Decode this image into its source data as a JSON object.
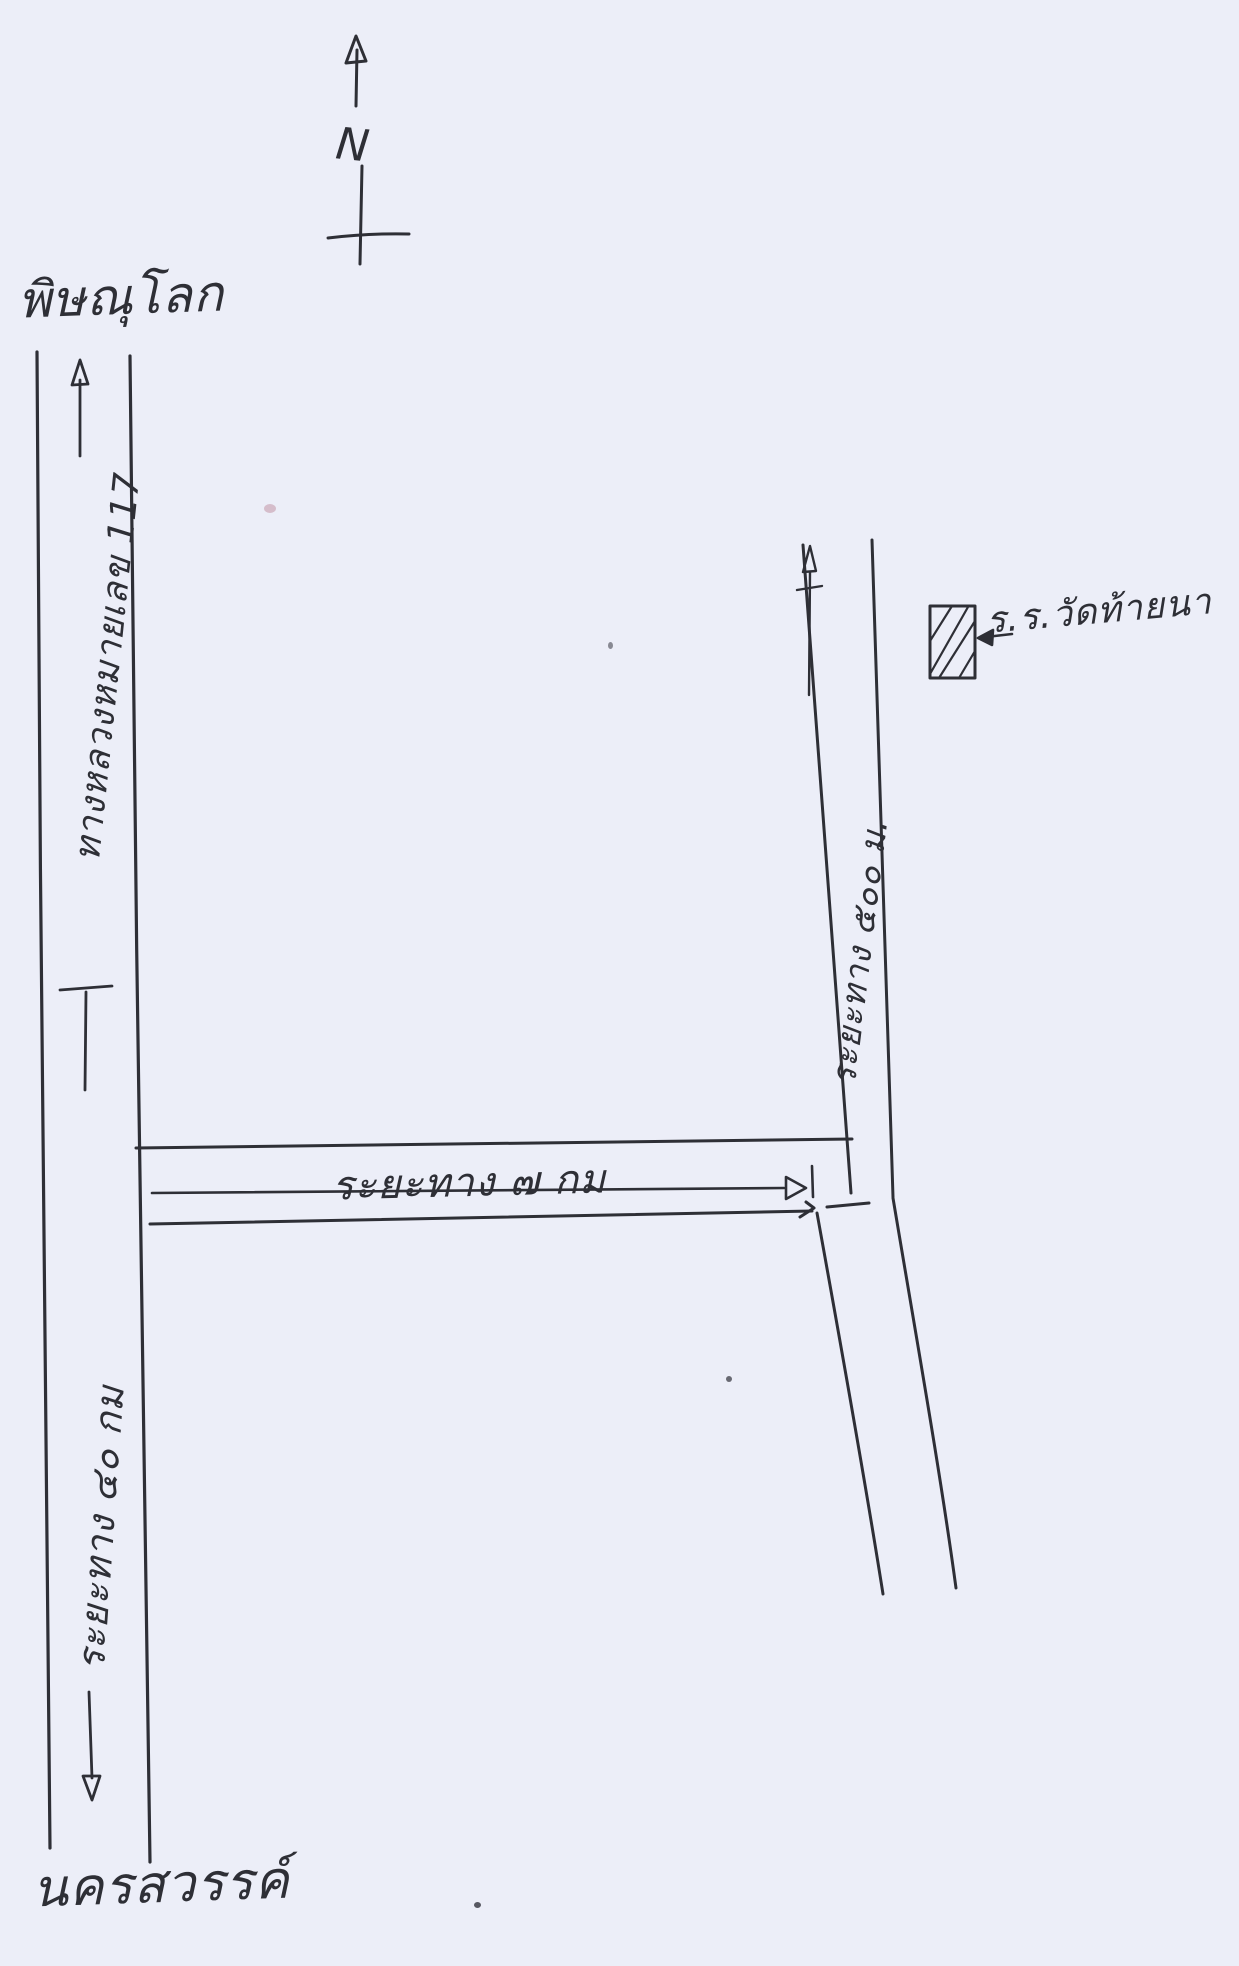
{
  "colors": {
    "paper": "#eceef8",
    "ink": "#2e2f36"
  },
  "compass": {
    "letter": "N"
  },
  "places": {
    "north_city": "พิษณุโลก",
    "south_city": "นครสวรรค์"
  },
  "roads": {
    "highway_label": "ทางหลวงหมายเลข 117",
    "south_leg_distance": "ระยะทาง ๔๐ กม",
    "branch_distance": "ระยะทาง ๗ กม",
    "side_road_distance": "ระยะทาง ๕๐๐ ม."
  },
  "landmark": {
    "label": "ร.ร.วัดท้ายนา",
    "marker": "hatched-rectangle"
  },
  "symbols": {
    "north_arrow": "upward arrow with letter N and cross",
    "northbound_arrow": "up arrow at top of highway",
    "southbound_arrow": "down arrow at bottom of highway",
    "branch_measure_arrow": "rightward measurement arrow on branch road",
    "side_road_arrow": "small up arrow on side road",
    "landmark_pointer": "left arrow pointing at hatched building"
  }
}
